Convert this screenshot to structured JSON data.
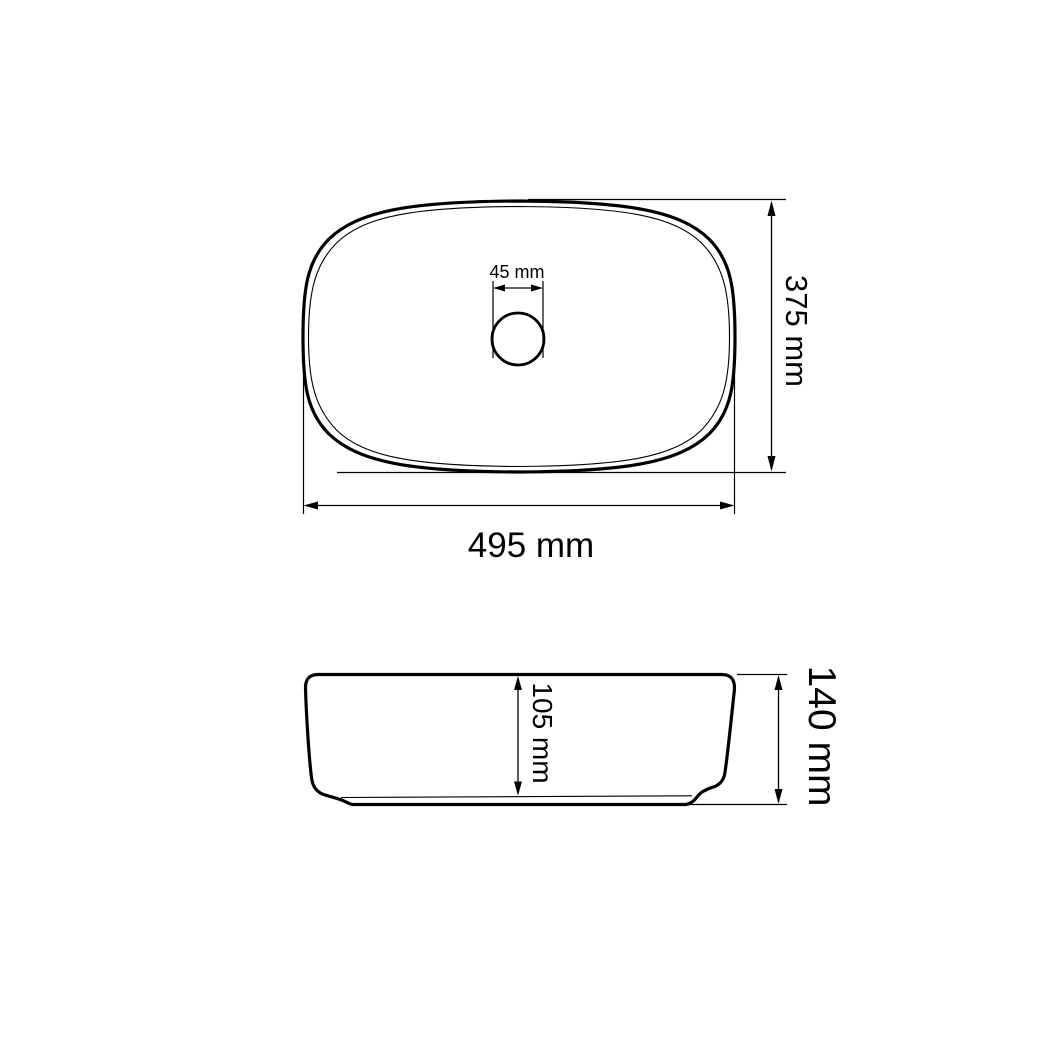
{
  "page": {
    "background_color": "#ffffff",
    "line_color": "#000000"
  },
  "top_view": {
    "drain_diameter_label": "45 mm",
    "height_label": "375 mm",
    "width_label": "495 mm"
  },
  "side_view": {
    "inner_depth_label": "105 mm",
    "overall_height_label": "140 mm"
  }
}
